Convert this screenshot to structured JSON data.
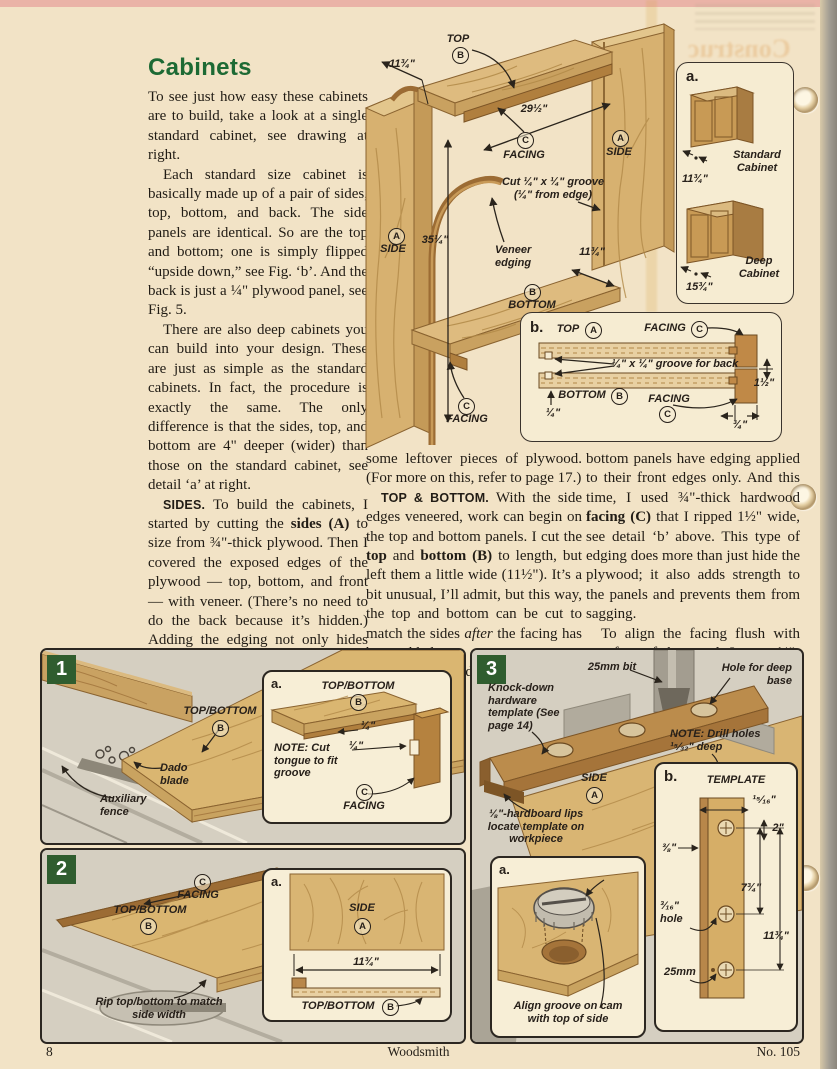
{
  "page_footer": {
    "page_number": "8",
    "magazine_title": "Woodsmith",
    "issue_number": "No. 105"
  },
  "ghost": {
    "text": "Construc"
  },
  "article": {
    "title": "Cabinets",
    "col1": [
      "To see just how easy these cabinets are to build, take a look at a single standard cabinet, see drawing at right.",
      "Each standard size cabinet is basically made up of a pair of sides, top, bottom, and back. The side panels are identical. So are the top and bottom; one is simply flipped “upside down,” see Fig. ‘b’. And the back is just a ¼\" plywood panel, see Fig. 5.",
      "There are also deep cabinets you can build into your design. These are just as simple as the standard cabinets. In fact, the procedure is exactly the same. The only difference is that the sides, top, and bottom are 4\" deeper (wider) than those on the standard cabinet, see detail ‘a’ at right.",
      "<b class=\"ri\">SIDES.</b> To build the cabinets, I started by cutting the <b>sides (A)</b> to size from ¾\"-thick plywood. Then I covered the exposed edges of the plywood — top, bottom, and front — with veneer. (There’s no need to do the back because it’s hidden.) Adding the edging not only hides the plywood, it also helps protect the face veneer from chipping.",
      "Note: You can buy veneer edging, see page 35 for sources. The only problem is the color may not match your plywood. For a perfect match, I made my own veneer edging from"
    ],
    "col2": [
      "some leftover pieces of plywood. (For more on this, refer to page 17.)",
      "<b class=\"ri\">TOP &amp; BOTTOM.</b> With the side edges veneered, work can begin on the top and bottom panels. I cut the <b>top</b> and <b>bottom (B)</b> to length, but left them a little wide (11½\"). It’s a bit unusual, I’ll admit, but this way, the top and bottom can be cut to match the sides <i>after</i> the facing has been added.",
      "Unlike the side panels, the top and"
    ],
    "col3": [
      "bottom panels have edging applied to their front edges only. And this time, I used ¾\"-thick hardwood <b>facing (C)</b> that I ripped 1½\" wide, see detail ‘b’ above. This type of edging does more than just hide the plywood; it also adds strength to the panels and prevents them from sagging.",
      "To align the facing flush with one face of the panel, I cut a ¼\"-wide groove in the facing and a mating"
    ]
  },
  "main_drawing": {
    "top_label": "TOP",
    "top_letter": "B",
    "dim_depth_top": "11¾\"",
    "dim_width": "29½\"",
    "facing_top_label": "FACING",
    "facing_top_letter": "C",
    "side_right_label": "SIDE",
    "side_right_letter": "A",
    "groove_note": "Cut ¼\" x ¼\" groove (¼\" from edge)",
    "veneer_note": "Veneer edging",
    "dim_height": "35¼\"",
    "side_left_label": "SIDE",
    "side_left_letter": "A",
    "bottom_label": "BOTTOM",
    "bottom_letter": "B",
    "dim_depth_bottom": "11¾\"",
    "facing_bottom_label": "FACING",
    "facing_bottom_letter": "C"
  },
  "detail_a": {
    "label": "a.",
    "standard_caption": "Standard Cabinet",
    "standard_dim": "11¾\"",
    "deep_caption": "Deep Cabinet",
    "deep_dim": "15¾\""
  },
  "detail_b": {
    "label": "b.",
    "top_label": "TOP",
    "top_letter": "A",
    "facing_top_label": "FACING",
    "facing_top_letter": "C",
    "groove_note": "¼\" x ¼\" groove for back",
    "bottom_label": "BOTTOM",
    "bottom_letter": "B",
    "quarter_dim": "¼\"",
    "facing_bottom_label": "FACING",
    "facing_bottom_letter": "C",
    "height_dim": "1½\"",
    "thickness_dim": "¾\""
  },
  "fig1": {
    "number": "1",
    "workpiece_label": "TOP/BOTTOM",
    "workpiece_letter": "B",
    "dado_label": "Dado blade",
    "fence_label": "Auxiliary fence",
    "inset": {
      "label": "a.",
      "workpiece_label": "TOP/BOTTOM",
      "workpiece_letter": "B",
      "note": "<b>NOTE:</b> Cut tongue to fit groove",
      "dim1": "¼\"",
      "dim2": "¼\"",
      "facing_label": "FACING",
      "facing_letter": "C"
    }
  },
  "fig2": {
    "number": "2",
    "facing_label": "FACING",
    "facing_letter": "C",
    "workpiece_label": "TOP/BOTTOM",
    "workpiece_letter": "B",
    "rip_note": "Rip top/bottom to match side width",
    "inset": {
      "label": "a.",
      "side_label": "SIDE",
      "side_letter": "A",
      "dim": "11¾\"",
      "workpiece_label": "TOP/BOTTOM",
      "workpiece_letter": "B"
    }
  },
  "fig3": {
    "number": "3",
    "bit_label": "25mm bit",
    "hole_label": "Hole for deep base",
    "template_note": "Knock-down hardware template (See page 14)",
    "drill_note": "<b>NOTE:</b> Drill holes ¹⁵⁄₃₂\" deep",
    "side_label": "SIDE",
    "side_letter": "A",
    "hardboard_note": "⅛\"-hardboard lips locate template on workpiece",
    "inset_a": {
      "label": "a.",
      "caption": "Align groove on cam with top of side"
    },
    "inset_b": {
      "label": "b.",
      "title": "TEMPLATE",
      "dim_top": "¹⁵⁄₁₆\"",
      "dim_2": "2\"",
      "dim_38": "⅜\"",
      "dim_734": "7¾\"",
      "hole_dim": "³⁄₁₆\" hole",
      "dim_1134": "11¾\"",
      "dim_25": "25mm"
    }
  }
}
